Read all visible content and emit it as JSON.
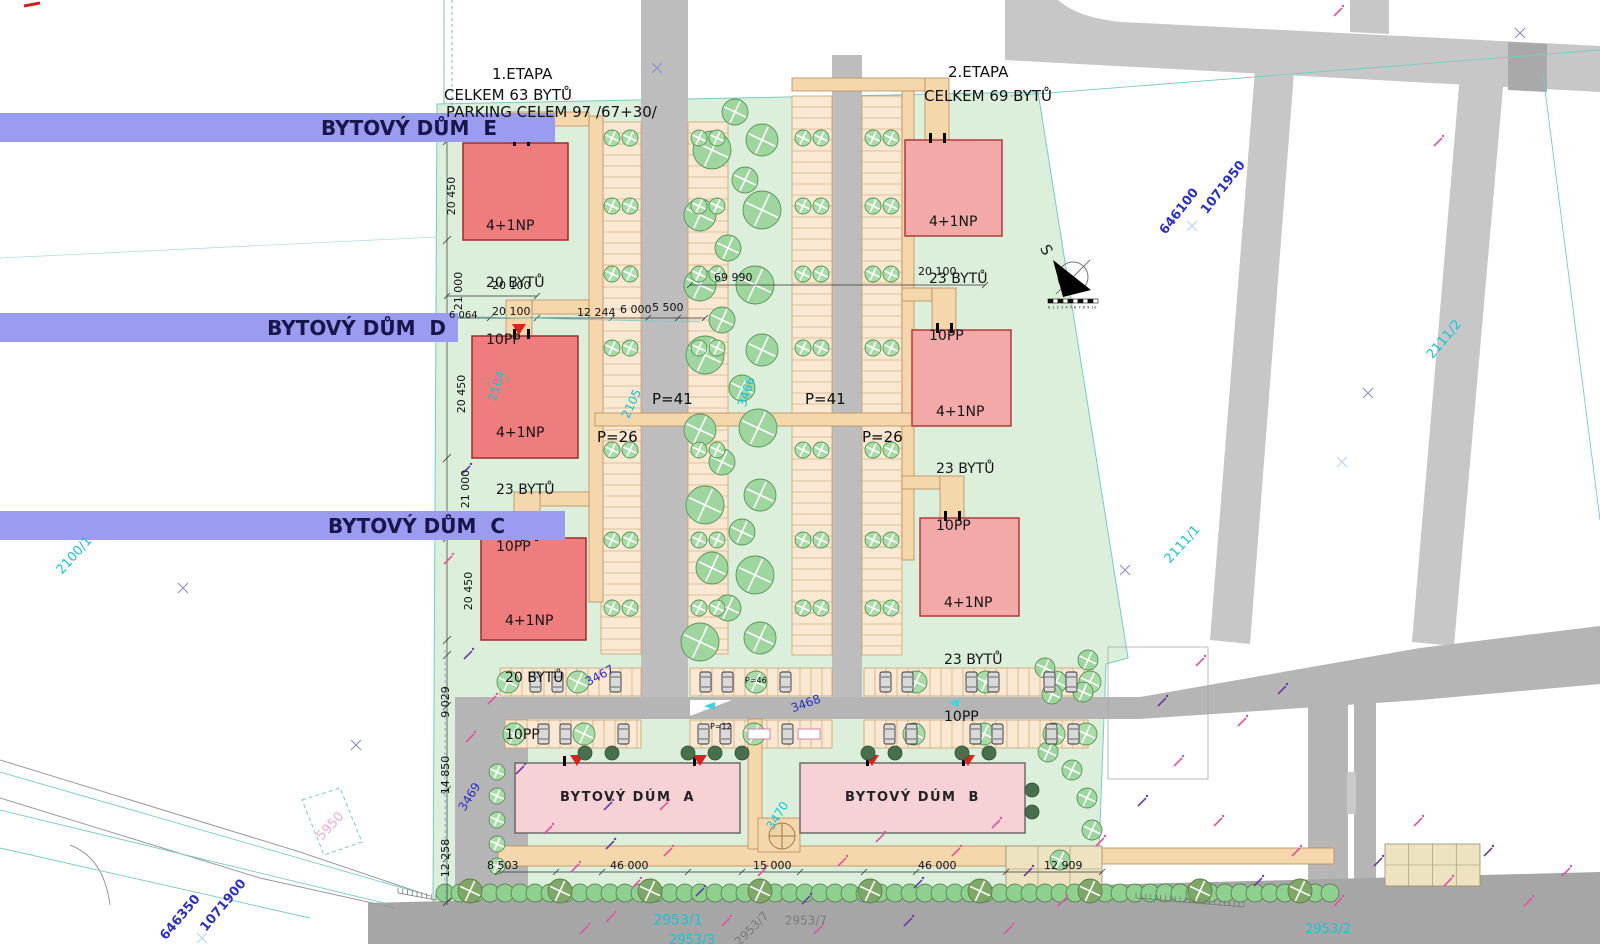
{
  "plan": {
    "stage1": {
      "title": "1.ETAPA",
      "subtitle1": "CELKEM 63 BYTŮ",
      "subtitle2": "PARKING CELEM 97 /67+30/"
    },
    "stage2": {
      "title": "2.ETAPA",
      "subtitle1": "CELKEM 69 BYTŮ"
    }
  },
  "building_bars": [
    {
      "label": "BYTOVÝ DŮM  E"
    },
    {
      "label": "BYTOVÝ DŮM  D"
    },
    {
      "label": "BYTOVÝ DŮM  C"
    }
  ],
  "stage1_buildings": [
    {
      "name": "E",
      "floors": "4+1NP",
      "units": "20 BYTŮ",
      "parking": "10PP"
    },
    {
      "name": "D",
      "floors": "4+1NP",
      "units": "23 BYTŮ",
      "parking": "10PP"
    },
    {
      "name": "C",
      "floors": "4+1NP",
      "units": "20 BYTŮ",
      "parking": "10PP"
    }
  ],
  "stage2_buildings": [
    {
      "floors": "4+1NP",
      "units": "23 BYTŮ",
      "parking": "10PP"
    },
    {
      "floors": "4+1NP",
      "units": "23 BYTŮ",
      "parking": "10PP"
    },
    {
      "floors": "4+1NP",
      "units": "23 BYTŮ",
      "parking": "10PP"
    }
  ],
  "bottom_buildings": [
    {
      "label": "BYTOVÝ DÚM  A"
    },
    {
      "label": "BYTOVÝ DÚM  B"
    }
  ],
  "parking_counts": {
    "p41a": "P=41",
    "p41b": "P=41",
    "p26a": "P=26",
    "p26b": "P=26",
    "p46": "P=46",
    "p12": "P=12"
  },
  "dimensions": {
    "left_vertical": [
      "20 450",
      "21 000",
      "20 450",
      "21 000",
      "20 450"
    ],
    "d6064": "6 064",
    "d20100a": "20 100",
    "d20100b": "20 100",
    "d12244": "12 244",
    "d6000": "6 000",
    "d5500": "5 500",
    "d69990": "69 990",
    "d20100c": "20 100",
    "bl_vertical": [
      "9 029",
      "14 850",
      "12 258"
    ],
    "d8503": "8 503",
    "d46000a": "46 000",
    "d15000": "15 000",
    "d46000b": "46 000",
    "d12909": "12 909"
  },
  "survey_coords": {
    "ne_x": "646100",
    "ne_y": "1071950",
    "sw_x": "646350",
    "sw_y": "1071900"
  },
  "parcels": {
    "c2104": "2104",
    "c2105": "2105",
    "c3466": "3466",
    "c3470": "3470",
    "c2111_1": "2111/1",
    "c2111_2": "2111/2",
    "c2100_1": "2100/1",
    "c2953_1": "2953/1",
    "c2953_2": "2953/2",
    "c2953_3": "2953/3",
    "b3467": "3467",
    "b3468": "3468",
    "b3469": "3469",
    "g2953_7a": "2953/7",
    "g2953_7b": "2953/7",
    "pink5950": "5950"
  },
  "north": {
    "label": "S",
    "scale_numbers": "0 1 2 3 4 5 6 7 8 9 10"
  },
  "colors": {
    "site_green": "#dcefda",
    "road": "#c4c4c4",
    "stage1_building": "#ef7d7d",
    "stage2_building": "#f4a9a9",
    "bottom_building": "#f6d2d6",
    "bar_purple": "#9b9bef",
    "accent_cyan": "#14c4d4",
    "accent_blue": "#2a2fc4",
    "accent_magenta": "#d957a3",
    "path_tan": "#f4d7ab"
  }
}
